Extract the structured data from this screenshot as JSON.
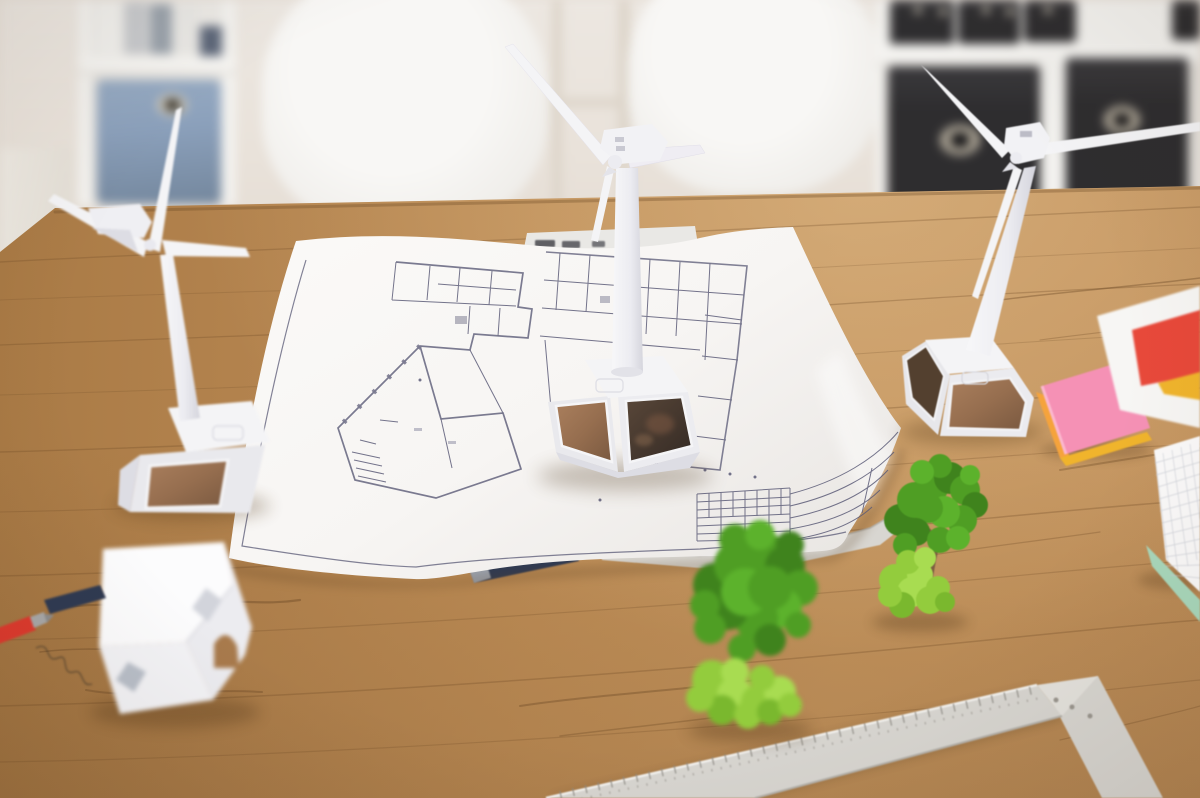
{
  "scene": {
    "title": "Wind energy planning concept photo",
    "description": "Top-down angled photo of a wooden architect desk with three model wind turbines on solar-panel bases standing on and around a building floor-plan blueprint, two green model trees, a folded paper house model, a red pen and graphite pencils, neon sticky notes, a color-sample sheet, a squared notepad on a mint cover, and a light-gray T-square ruler. Blurred background shows white shelving with binders, a blue fabric box, black fabric storage cubes and white chairs.",
    "objects": [
      {
        "name": "bookshelf-left",
        "desc": "white shelf with white and gray binders and a blue fabric storage box"
      },
      {
        "name": "bookshelf-right",
        "desc": "white cube shelf with black binders on top and two black fabric boxes with metal grommets"
      },
      {
        "name": "chair-left",
        "desc": "white molded chair back, out of focus"
      },
      {
        "name": "chair-right",
        "desc": "white molded chair back, out of focus"
      },
      {
        "name": "desk",
        "desc": "oak wood desktop with visible grain"
      },
      {
        "name": "blueprint-floor-plan",
        "desc": "large curled sheet with architectural floor plan and schedule table"
      },
      {
        "name": "wind-turbine-left",
        "desc": "white model wind turbine on trapezoid base with copper solar panel"
      },
      {
        "name": "wind-turbine-middle",
        "desc": "white model wind turbine standing on the blueprint, base with two solar panels"
      },
      {
        "name": "wind-turbine-right",
        "desc": "white model wind turbine on desk beside sticky notes"
      },
      {
        "name": "paper-house-model",
        "desc": "white folded paper house with diamond windows and arched door cutout"
      },
      {
        "name": "model-tree-large",
        "desc": "green model tree with light-green moss base, foreground, out of focus"
      },
      {
        "name": "model-tree-small",
        "desc": "green model tree with light-green moss base"
      },
      {
        "name": "t-square-ruler",
        "desc": "light gray L-shaped drafting ruler with tick marks and screws"
      },
      {
        "name": "ruler-under-blueprint",
        "desc": "gray ruler edge peeking from under the blueprint"
      },
      {
        "name": "sticky-notes",
        "desc": "stack of neon sticky notes, pink on top, orange and yellow beneath"
      },
      {
        "name": "color-sample-sheet",
        "desc": "white sheet with red and yellow color blocks"
      },
      {
        "name": "notepad",
        "desc": "squared-paper notepad on a mint green cover"
      },
      {
        "name": "red-pen",
        "desc": "red pen with metal tip"
      },
      {
        "name": "graphite-pencil",
        "desc": "dark navy pencil stub"
      },
      {
        "name": "pencil-under-blueprint",
        "desc": "navy pencil sticking out from under the blueprint edge"
      },
      {
        "name": "fiber-curl",
        "desc": "thin dark fiber curl on the desk"
      }
    ],
    "counts": {
      "wind_turbines": 3,
      "model_trees": 2,
      "chairs": 2,
      "black_boxes": 2
    }
  },
  "palette": {
    "wood": "#bd8c55",
    "wood_dark": "#8a6238",
    "wall": "#e9e3dc",
    "shelf_white": "#f3f2ef",
    "box_black": "#2e2d2f",
    "fabric_blue": "#8ba0bb",
    "grommet": "#b7b0a2",
    "paper": "#f8f6f4",
    "plan_line": "#5c5c78",
    "turbine_white": "#f4f4f6",
    "turbine_shade": "#dddde4",
    "panel_copper": "#966e4f",
    "panel_dark": "#463931",
    "tree_green": "#4f9e24",
    "tree_green_dark": "#3f831d",
    "moss_green": "#93cc3d",
    "trunk_brown": "#7d5f42",
    "ruler_gray": "#d8d6d1",
    "sticky_pink": "#f591b5",
    "sticky_orange": "#f5a33c",
    "paper_red": "#e8493a",
    "paper_yellow": "#f0b42c",
    "mint_green": "#a9d8bc",
    "pen_red": "#dd3a2e",
    "pen_navy": "#2f3a52"
  }
}
